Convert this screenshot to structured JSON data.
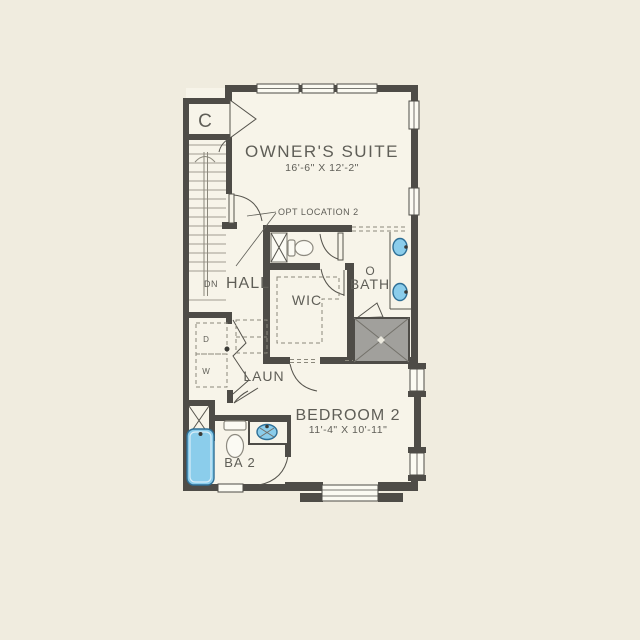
{
  "labels": {
    "closet": "C",
    "owners_suite": "OWNER'S SUITE",
    "owners_suite_dims": "16'-6\" X 12'-2\"",
    "opt_location": "OPT LOCATION 2",
    "stairs_direction": "DN",
    "hall": "HALL",
    "wic": "WIC",
    "obath_line1": "O",
    "obath_line2": "BATH",
    "laundry": "LAUN",
    "dryer": "D",
    "washer": "W",
    "bath2": "BA 2",
    "bedroom2": "BEDROOM 2",
    "bedroom2_dims": "11'-4\" X 10'-11\""
  },
  "colors": {
    "page_bg": "#f0ecdf",
    "floor": "#f7f4e9",
    "wall": "#4e4c47",
    "line": "#55534c",
    "stair_line": "#a29d91",
    "dash_line": "#8b887c",
    "text": "#5f5e57",
    "window_fill": "#fbfaf2",
    "fixture_blue": "#8bcdeb",
    "fixture_blue_stroke": "#2e6f96",
    "porcelain": "#fbfaf3",
    "porcelain_stroke": "#8d8a80",
    "shower_gray": "#a1a09c",
    "shower_line": "#73716a"
  }
}
